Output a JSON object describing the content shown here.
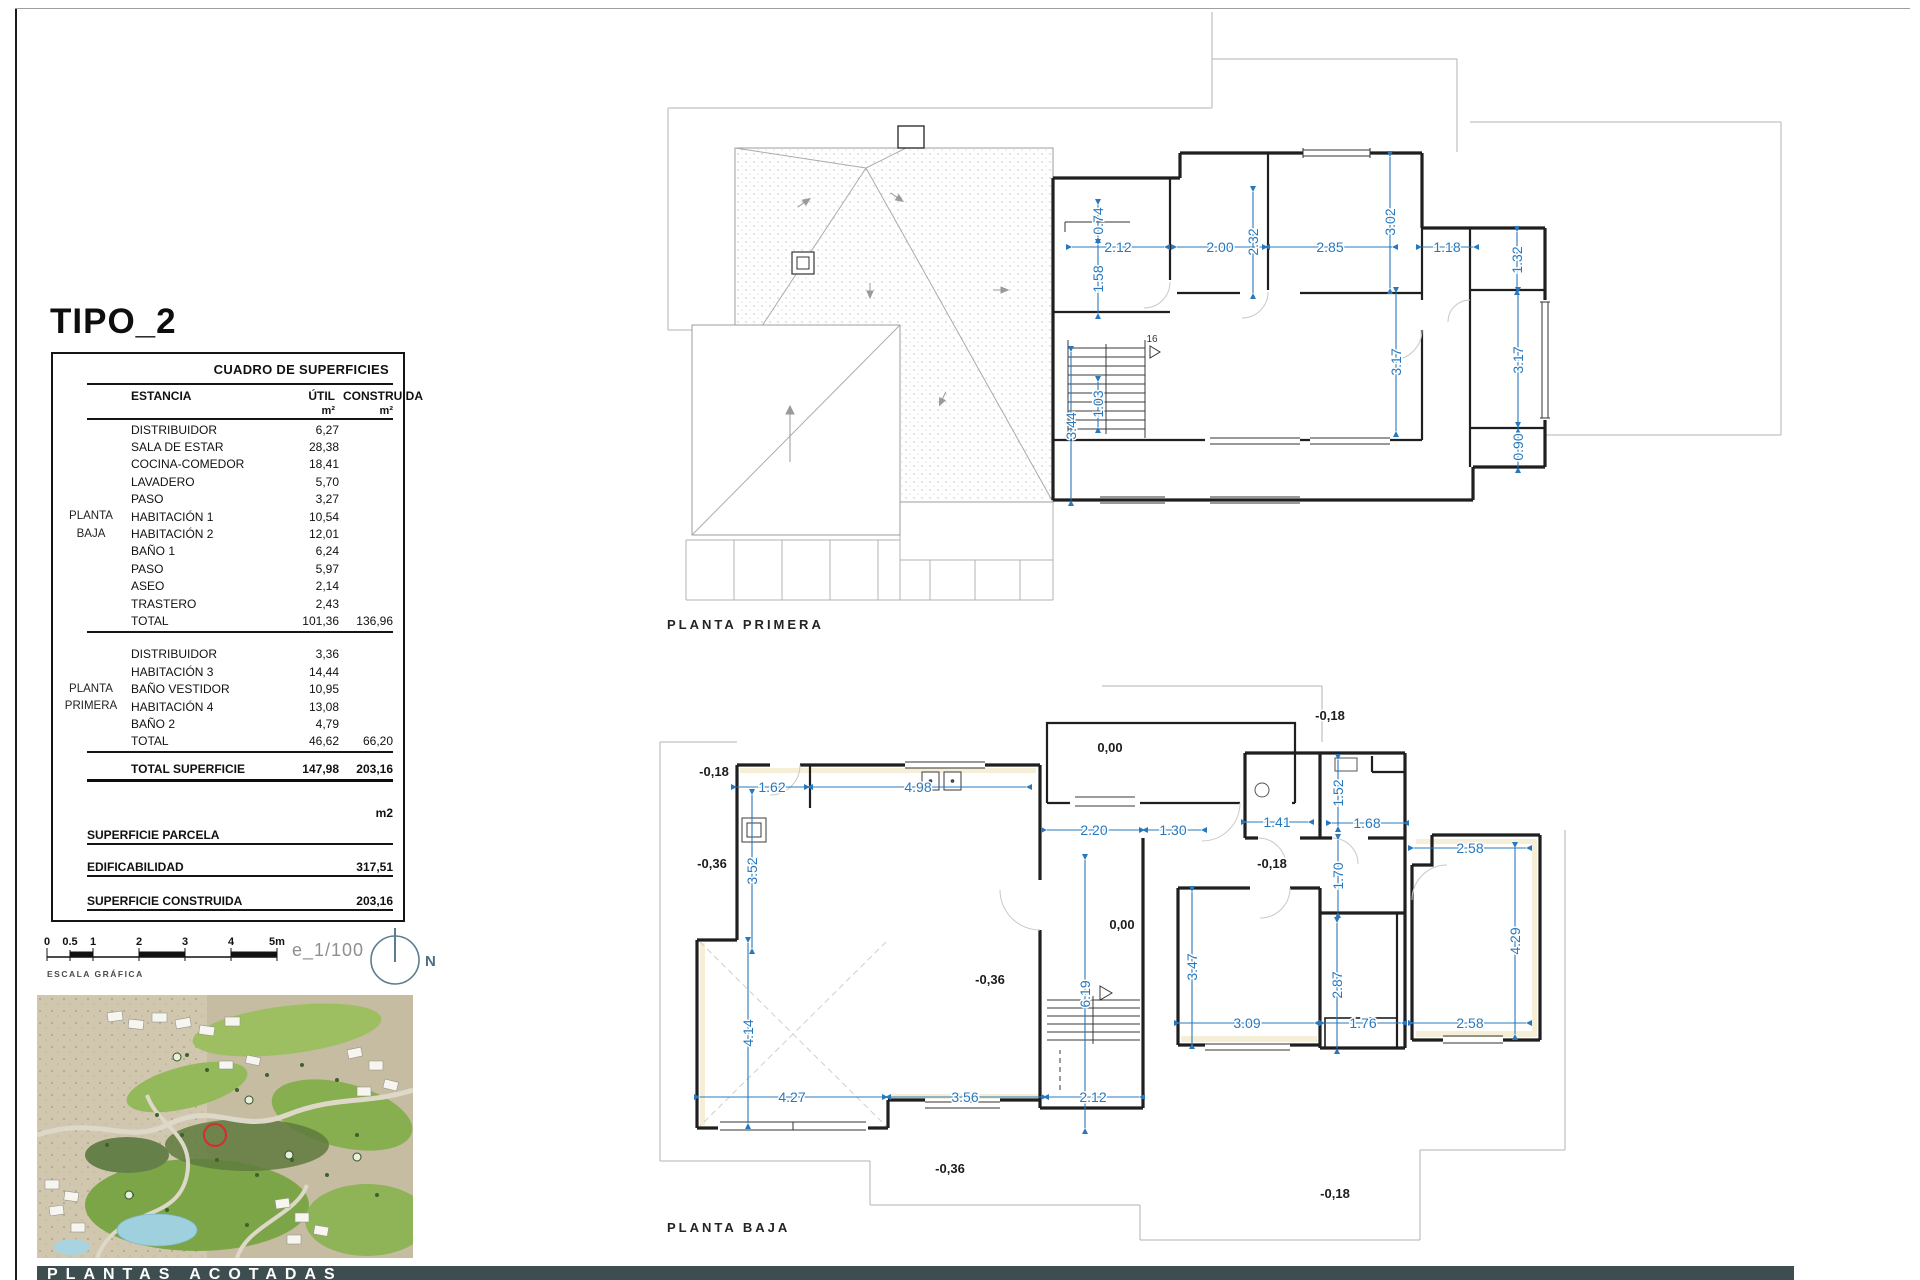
{
  "title": "TIPO_2",
  "colors": {
    "dim_blue": "#2878be",
    "bar_bg": "#3e4e50",
    "red_marker": "#d13030"
  },
  "table": {
    "header": "CUADRO DE SUPERFICIES",
    "col_estancia": "ESTANCIA",
    "col_util": "ÚTIL",
    "col_construida": "CONSTRUIDA",
    "unit": "m²",
    "unit2": "m²",
    "groups": [
      {
        "name_line1": "PLANTA",
        "name_line2": "BAJA",
        "rows": [
          [
            "DISTRIBUIDOR",
            "6,27"
          ],
          [
            "SALA DE ESTAR",
            "28,38"
          ],
          [
            "COCINA-COMEDOR",
            "18,41"
          ],
          [
            "LAVADERO",
            "5,70"
          ],
          [
            "PASO",
            "3,27"
          ],
          [
            "HABITACIÓN 1",
            "10,54"
          ],
          [
            "HABITACIÓN 2",
            "12,01"
          ],
          [
            "BAÑO 1",
            "6,24"
          ],
          [
            "PASO",
            "5,97"
          ],
          [
            "ASEO",
            "2,14"
          ],
          [
            "TRASTERO",
            "2,43"
          ]
        ],
        "total_label": "TOTAL",
        "total_util": "101,36",
        "total_construida": "136,96"
      },
      {
        "name_line1": "PLANTA",
        "name_line2": "PRIMERA",
        "rows": [
          [
            "DISTRIBUIDOR",
            "3,36"
          ],
          [
            "HABITACIÓN 3",
            "14,44"
          ],
          [
            "BAÑO VESTIDOR",
            "10,95"
          ],
          [
            "HABITACIÓN 4",
            "13,08"
          ],
          [
            "BAÑO 2",
            "4,79"
          ]
        ],
        "total_label": "TOTAL",
        "total_util": "46,62",
        "total_construida": "66,20"
      }
    ],
    "footer": {
      "total_label": "TOTAL SUPERFICIE",
      "total_util": "147,98",
      "total_construida": "203,16",
      "m2": "m2",
      "parcela_label": "SUPERFICIE PARCELA",
      "edificabilidad_label": "EDIFICABILIDAD",
      "edificabilidad_value": "317,51",
      "construida_label": "SUPERFICIE CONSTRUIDA",
      "construida_value": "203,16"
    }
  },
  "scalebar": {
    "ticks": [
      "0",
      "0.5",
      "1",
      "2",
      "3",
      "4",
      "5m"
    ],
    "label": "ESCALA GRÁFICA",
    "scale_text": "e_1/100",
    "north": "N"
  },
  "plans": {
    "primera": {
      "label": "PLANTA PRIMERA",
      "stair16": "16",
      "dims": {
        "d074": "0.74",
        "d158": "1.58",
        "d103": "1.03",
        "d344": "3.44",
        "d212": "2.12",
        "d200": "2.00",
        "d232": "2.32",
        "d285": "2.85",
        "d302": "3.02",
        "d118": "1.18",
        "d132": "1.32",
        "d317a": "3.17",
        "d317b": "3.17",
        "d090": "0.90"
      }
    },
    "baja": {
      "label": "PLANTA BAJA",
      "dims": {
        "d162": "1.62",
        "d498": "4.98",
        "d352": "3.52",
        "d220": "2.20",
        "d130": "1.30",
        "d141": "1.41",
        "d152": "1.52",
        "d168": "1.68",
        "d258a": "2.58",
        "d170": "1.70",
        "d429": "4.29",
        "d347": "3.47",
        "d287": "2.87",
        "d619": "6.19",
        "d309": "3.09",
        "d176": "1.76",
        "d258b": "2.58",
        "d414": "4.14",
        "d427": "4.27",
        "d356": "3.56",
        "d212": "2.12"
      },
      "levels": {
        "t_left": "-0,18",
        "left": "-0,36",
        "porch": "0,00",
        "top_right": "-0,18",
        "mid_right": "-0,18",
        "hall": "0,00",
        "living": "-0,36",
        "bottom": "-0,36",
        "bottom_right": "-0,18"
      }
    }
  },
  "footer_bar": {
    "title": "PLANTAS ACOTADAS"
  }
}
